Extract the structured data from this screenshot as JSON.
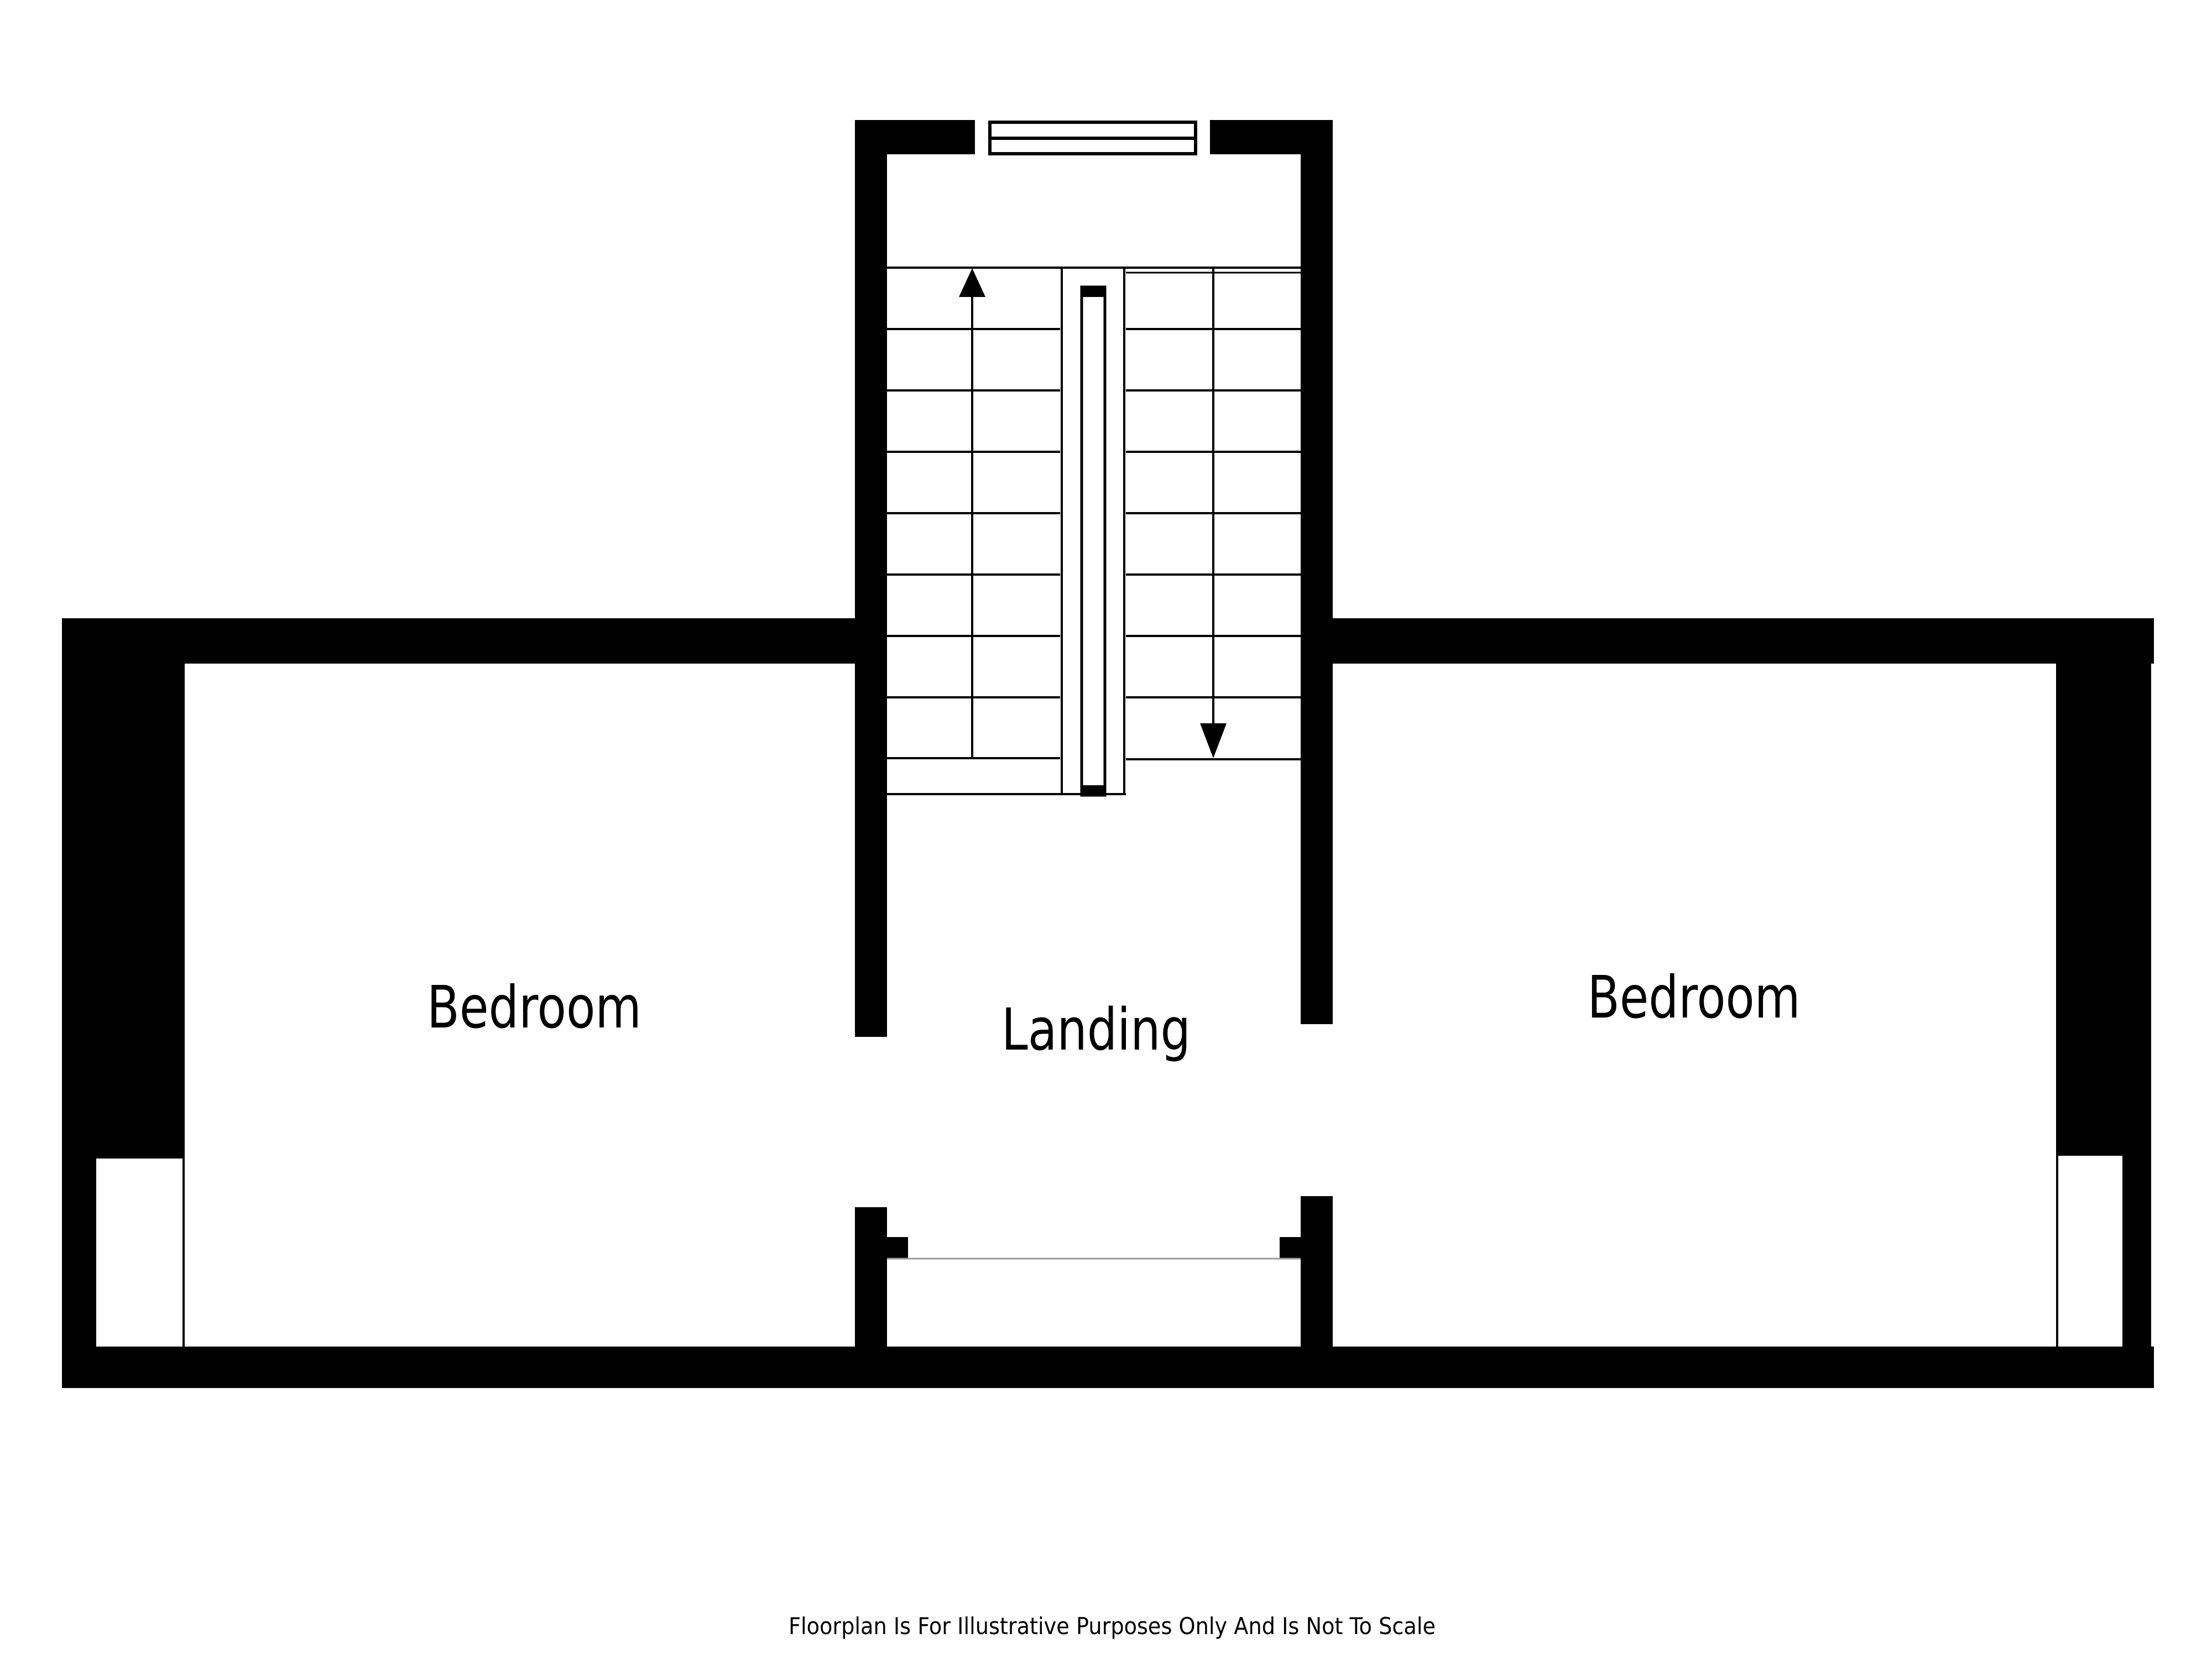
{
  "rooms": [
    {
      "id": "bedroom-left",
      "label": "Bedroom"
    },
    {
      "id": "landing",
      "label": "Landing"
    },
    {
      "id": "bedroom-right",
      "label": "Bedroom"
    }
  ],
  "stairs": {
    "up_arrow_icon": "up-arrow-icon",
    "down_arrow_icon": "down-arrow-icon"
  },
  "footer": {
    "disclaimer": "Floorplan Is For Illustrative Purposes Only And Is Not To Scale"
  },
  "colors": {
    "wall": "#000000",
    "background": "#ffffff",
    "opening_line": "#999999",
    "text": "#000000"
  }
}
